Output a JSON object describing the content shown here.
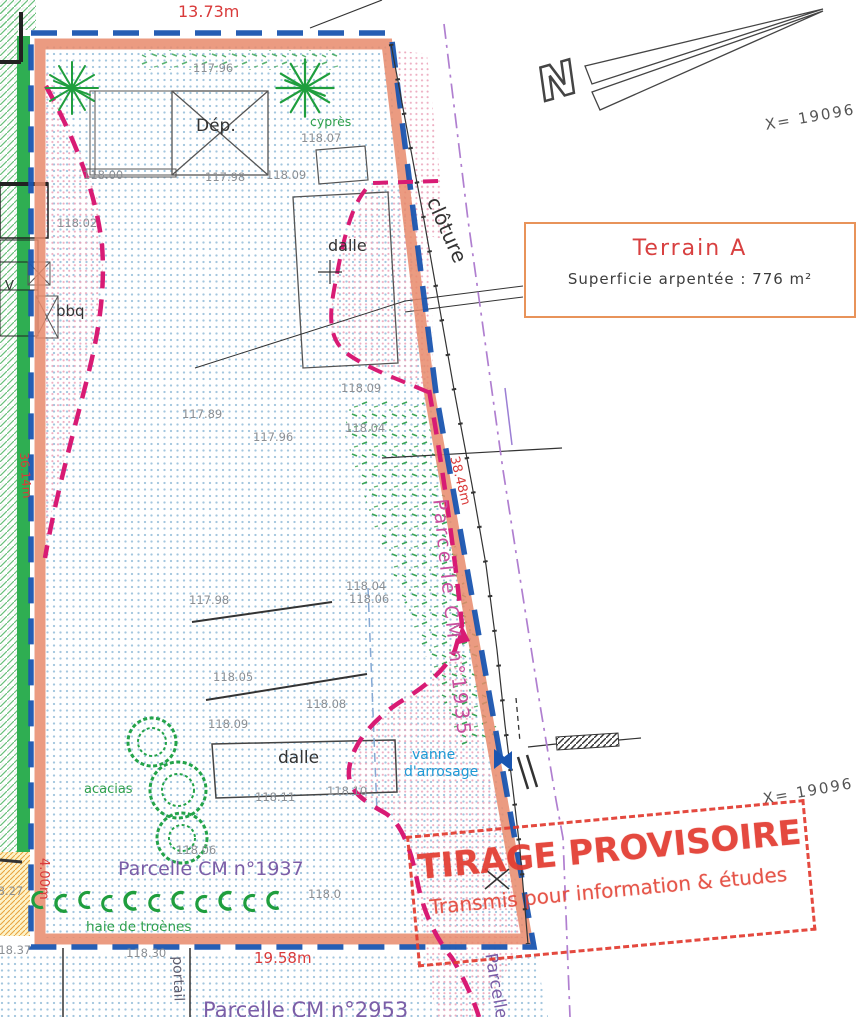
{
  "dimensions": {
    "north_side": "13.73m",
    "south_side": "19.58m",
    "east_side": "38.48m",
    "west_side": "36.14m",
    "south_west": "4.00m"
  },
  "north": {
    "label": "N"
  },
  "coordinates": {
    "x_top": "X= 19096",
    "x_bottom": "X= 19096"
  },
  "terrain_box": {
    "title": "Terrain A",
    "subtitle": "Superficie arpentée :  776  m²"
  },
  "stamp": {
    "line1": "TIRAGE PROVISOIRE",
    "line2": "Transmis pour information & études"
  },
  "parcels": {
    "east": "Parcelle CM n°1935",
    "current": "Parcelle CM n°1937",
    "south": "Parcelle CM n°2953",
    "south_east": "Parcelle"
  },
  "features": {
    "dep": "Dép.",
    "cypres": "cyprès",
    "dalle_upper": "dalle",
    "dalle_lower": "dalle",
    "bbq": "bbq",
    "v": "V",
    "cloture": "clôture",
    "vanne_line1": "vanne",
    "vanne_line2": "d'arrosage",
    "acacias": "acacias",
    "haie": "haie de troènes",
    "portail": "portail"
  },
  "elevations": [
    "117.96",
    "118.00",
    "117.98",
    "118.09",
    "118.07",
    "118.02",
    "117.89",
    "118.09",
    "117.96",
    "118.04",
    "117.98",
    "118.04",
    "118.06",
    "118.05",
    "118.08",
    "118.09",
    "118.11",
    "118.10",
    "118.06",
    "118.0",
    "118.27",
    "118.37",
    "118.30"
  ],
  "colors": {
    "boundary_salmon": "#e8896b",
    "boundary_blue": "#1a55b0",
    "old_fence_magenta": "#d81b74",
    "axis_purple": "#b07fd0",
    "dimension_red": "#d93a3a",
    "stamp_red": "#e23c31",
    "vegetation_green": "#2fa04d",
    "parcel_purple": "#7b5ea7",
    "water_cyan": "#1d9ad6"
  }
}
